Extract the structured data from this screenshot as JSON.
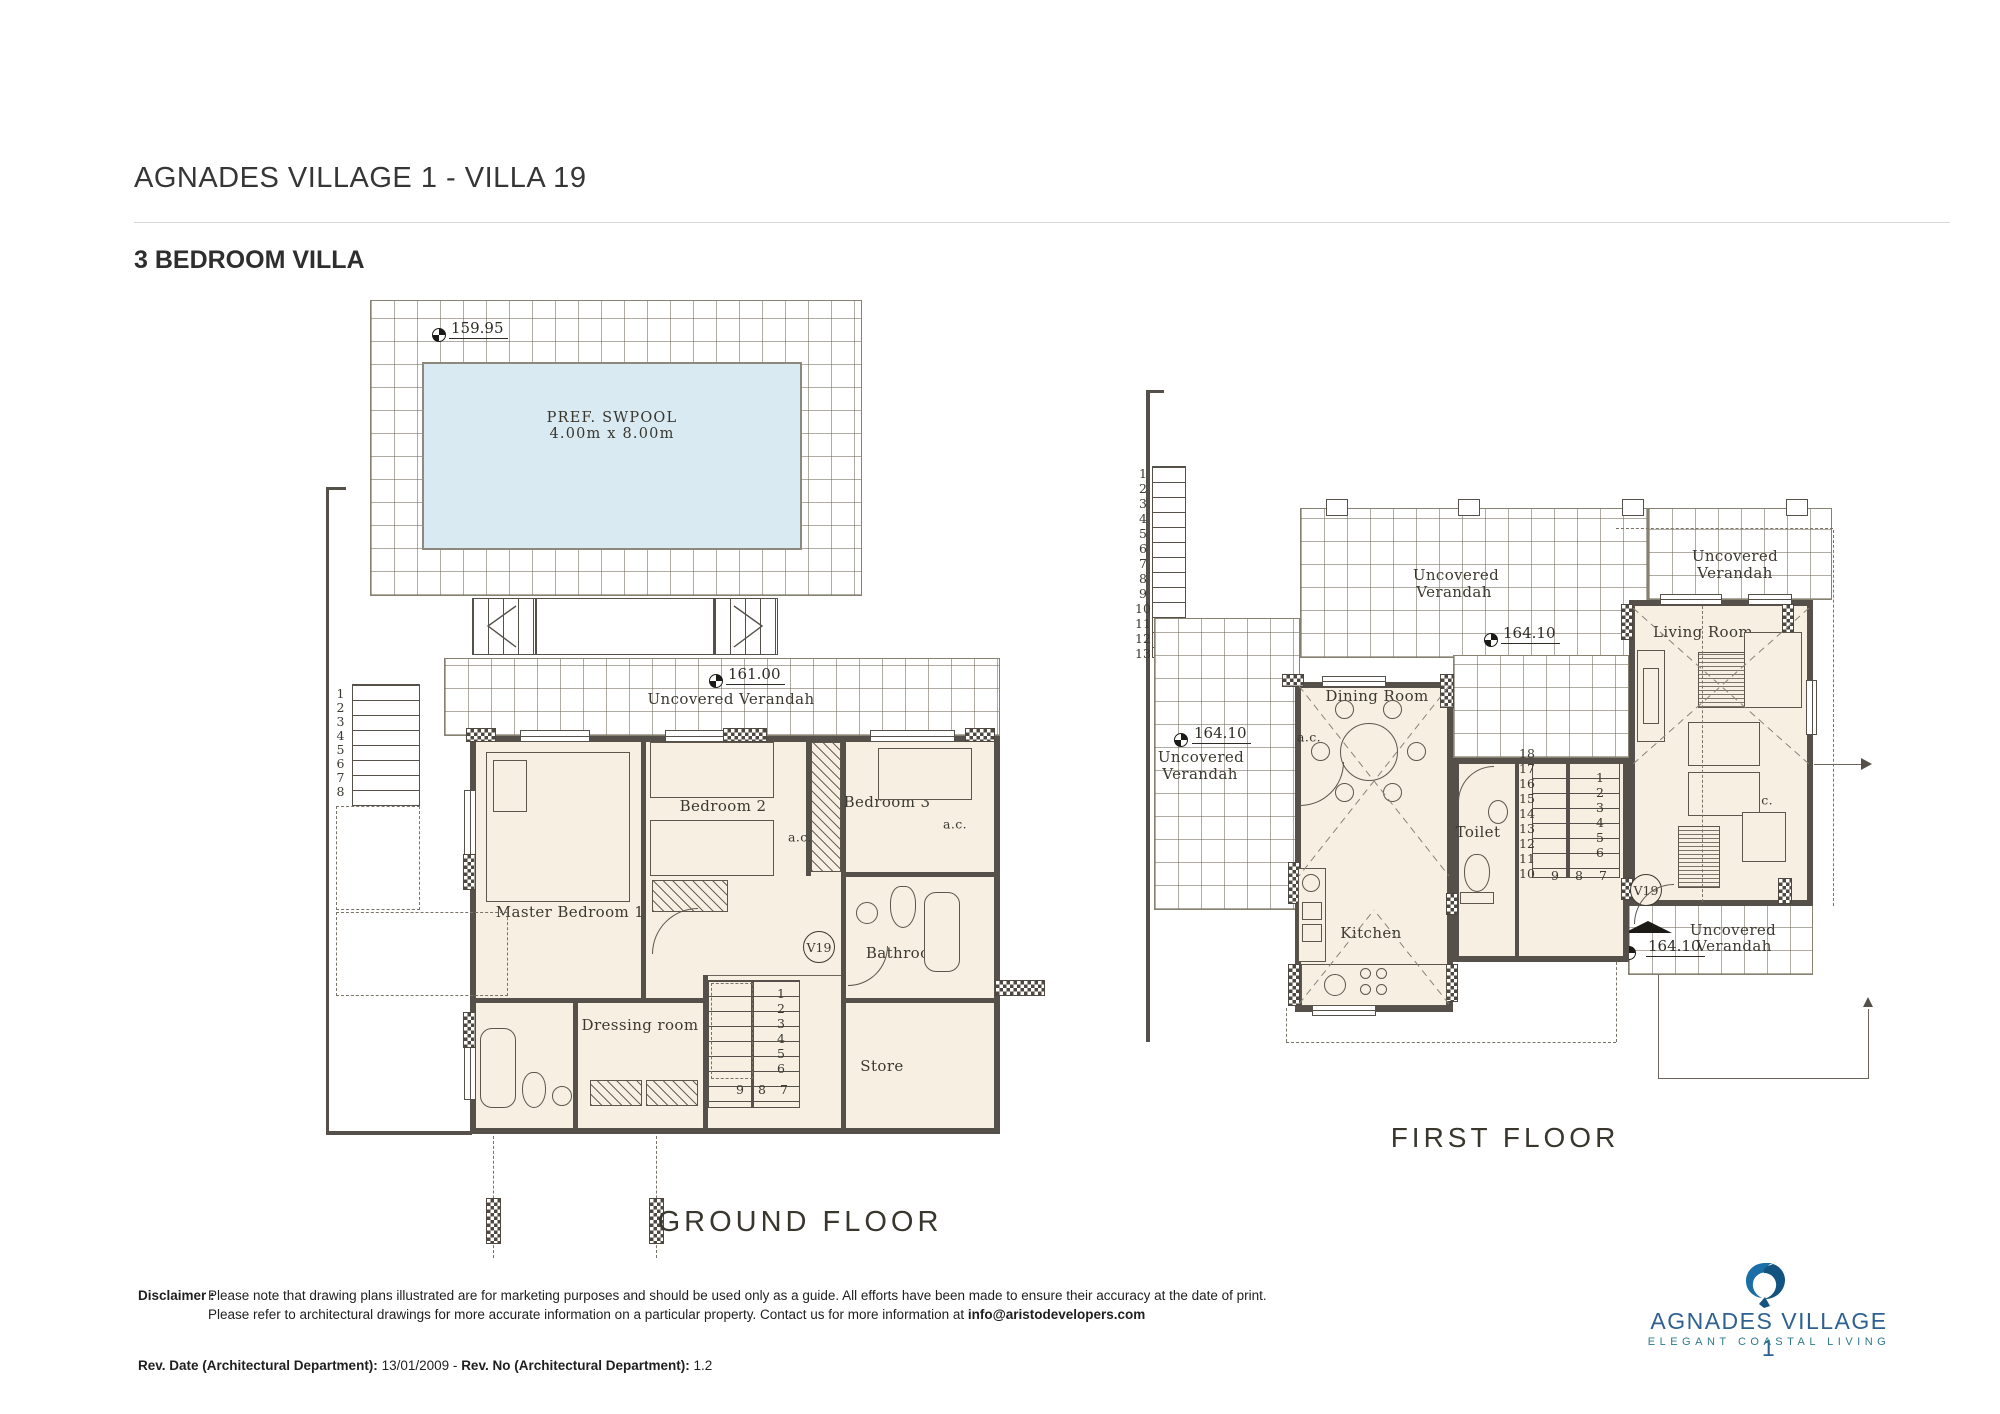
{
  "colors": {
    "pool_fill": "#d9eaf3",
    "room_fill": "#f6efe2",
    "plan_line": "#56504a",
    "logo_blue": "#2e6191",
    "logo_teal": "#2d7a8a"
  },
  "header": {
    "title": "AGNADES VILLAGE 1 - VILLA 19",
    "subtitle": "3 BEDROOM VILLA"
  },
  "ground_floor": {
    "caption": "GROUND FLOOR",
    "pool": {
      "line1": "PREF. SWPOOL",
      "line2": "4.00m x 8.00m",
      "level": "159.95"
    },
    "verandah": {
      "label": "Uncovered Verandah",
      "level": "161.00"
    },
    "rooms": {
      "master": "Master Bedroom 1",
      "bedroom2": "Bedroom 2",
      "bedroom3": "Bedroom 3",
      "bathroom": "Bathroom",
      "dressing": "Dressing room",
      "store": "Store"
    },
    "ac": "a.c.",
    "badge": "V19",
    "outer_stairs": [
      "1",
      "2",
      "3",
      "4",
      "5",
      "6",
      "7",
      "8"
    ],
    "inner_stairs_col": [
      "1",
      "2",
      "3",
      "4",
      "5",
      "6"
    ],
    "inner_stairs_row": [
      "9",
      "8",
      "7"
    ]
  },
  "first_floor": {
    "caption": "FIRST FLOOR",
    "verandah": {
      "word1": "Uncovered",
      "word2": "Verandah",
      "level": "164.10"
    },
    "rooms": {
      "dining": "Dining Room",
      "kitchen": "Kitchen",
      "toilet": "Toilet",
      "living": "Living Room"
    },
    "ac": "a.c.",
    "badge": "V19",
    "outer_stairs_col": [
      "1",
      "2",
      "3",
      "4",
      "5",
      "6",
      "7",
      "8",
      "9",
      "10",
      "11",
      "12",
      "13"
    ],
    "outer_stairs_row": [
      "14",
      "15",
      "16",
      "17",
      "18"
    ],
    "inner_stairs_left": [
      "18",
      "17",
      "16",
      "15",
      "14",
      "13",
      "12",
      "11",
      "10"
    ],
    "inner_stairs_right": [
      "1",
      "2",
      "3",
      "4",
      "5",
      "6"
    ],
    "inner_stairs_row": [
      "9",
      "8",
      "7"
    ]
  },
  "footer": {
    "disclaimer_label": "Disclaimer :",
    "disclaimer_line1": "Please note that drawing plans illustrated are for marketing purposes and should be used only as a guide. All efforts have been made to ensure their accuracy at the date of print.",
    "disclaimer_line2": "Please refer to architectural drawings for more accurate information on a particular property. Contact us for more information at ",
    "disclaimer_email": "info@aristodevelopers.com",
    "rev_date_label": "Rev. Date (Architectural Department):",
    "rev_date": "13/01/2009",
    "rev_separator": "-",
    "rev_no_label": "Rev. No (Architectural Department):",
    "rev_no": "1.2"
  },
  "logo": {
    "name": "AGNADES VILLAGE 1",
    "tagline": "ELEGANT COASTAL LIVING"
  }
}
